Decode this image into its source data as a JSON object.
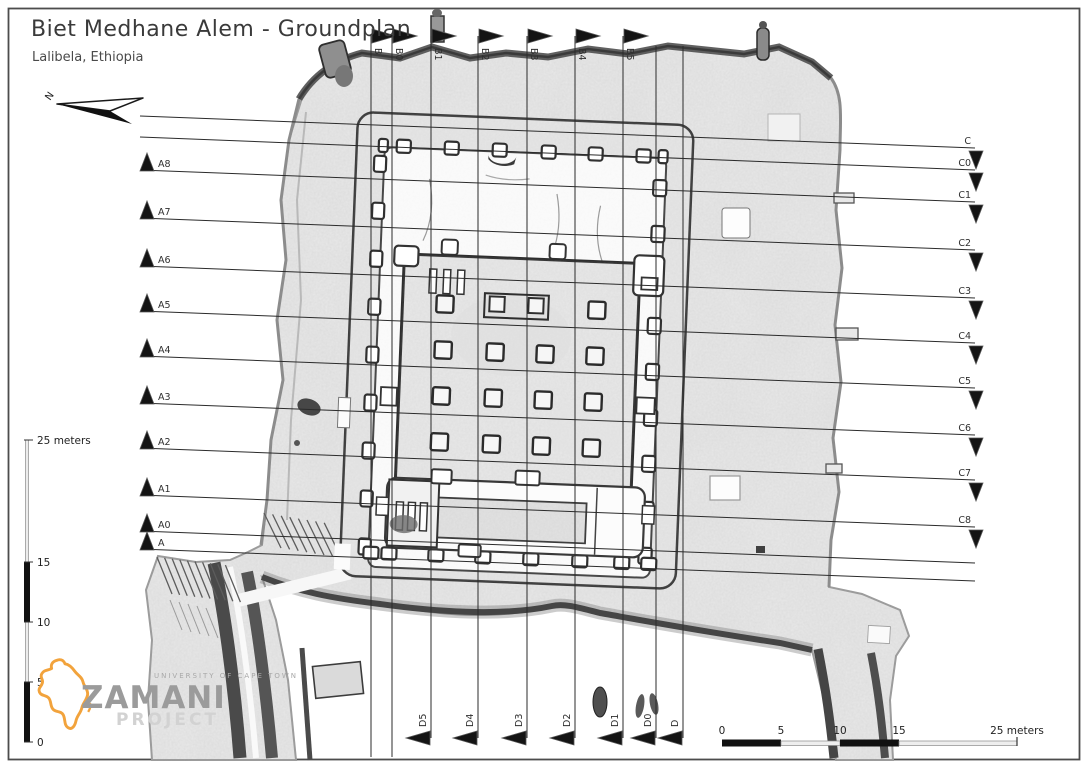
{
  "page": {
    "title": "Biet Medhane Alem - Groundplan",
    "subtitle": "Lalibela, Ethiopia"
  },
  "north": {
    "label": "N"
  },
  "sections": {
    "x_left": 140,
    "x_right": 975,
    "horizontal": [
      {
        "left": "",
        "right": "C",
        "yl": 116,
        "yr": 148
      },
      {
        "left": "",
        "right": "C0",
        "yl": 137,
        "yr": 170
      },
      {
        "left": "A8",
        "right": "C1",
        "yl": 170,
        "yr": 202
      },
      {
        "left": "A7",
        "right": "C2",
        "yl": 218,
        "yr": 250
      },
      {
        "left": "A6",
        "right": "C3",
        "yl": 266,
        "yr": 298
      },
      {
        "left": "A5",
        "right": "C4",
        "yl": 311,
        "yr": 343
      },
      {
        "left": "A4",
        "right": "C5",
        "yl": 356,
        "yr": 388
      },
      {
        "left": "A3",
        "right": "C6",
        "yl": 403,
        "yr": 435
      },
      {
        "left": "A2",
        "right": "C7",
        "yl": 448,
        "yr": 480
      },
      {
        "left": "A1",
        "right": "C8",
        "yl": 495,
        "yr": 527
      },
      {
        "left": "A0",
        "right": "",
        "yl": 531,
        "yr": 563
      },
      {
        "left": "A",
        "right": "",
        "yl": 549,
        "yr": 581
      }
    ],
    "y_top": 36,
    "y_bottom": 738,
    "vertical": [
      {
        "top": "B",
        "bottom": "",
        "x": 371
      },
      {
        "top": "B0",
        "bottom": "",
        "x": 392
      },
      {
        "top": "B1",
        "bottom": "D5",
        "x": 431
      },
      {
        "top": "B2",
        "bottom": "D4",
        "x": 478
      },
      {
        "top": "B3",
        "bottom": "D3",
        "x": 527
      },
      {
        "top": "B4",
        "bottom": "D2",
        "x": 575
      },
      {
        "top": "B5",
        "bottom": "D1",
        "x": 623
      },
      {
        "top": "",
        "bottom": "D0",
        "x": 656
      },
      {
        "top": "",
        "bottom": "D",
        "x": 683
      }
    ]
  },
  "scale_vertical": {
    "label": "25 meters",
    "label_y": 444,
    "ticks": [
      {
        "t": "15",
        "y": 566
      },
      {
        "t": "10",
        "y": 626
      },
      {
        "t": "5",
        "y": 686
      },
      {
        "t": "0",
        "y": 746
      }
    ]
  },
  "scale_horizontal": {
    "ticks": [
      {
        "t": "0",
        "x": 722
      },
      {
        "t": "5",
        "x": 781
      },
      {
        "t": "10",
        "x": 840
      },
      {
        "t": "15",
        "x": 899
      },
      {
        "t": "25 meters",
        "x": 1017
      }
    ]
  },
  "logo": {
    "university": "UNIVERSITY OF CAPE TOWN",
    "name": "ZAMANI",
    "subname": "PROJECT",
    "africa_color": "#f2a33c",
    "text_color": "#9b9b9b"
  },
  "colors": {
    "section_line": "#2b2b2b",
    "marker": "#141414",
    "label": "#2f2f2f",
    "rock": "#eaeaea",
    "accent_dark": "#474747"
  }
}
